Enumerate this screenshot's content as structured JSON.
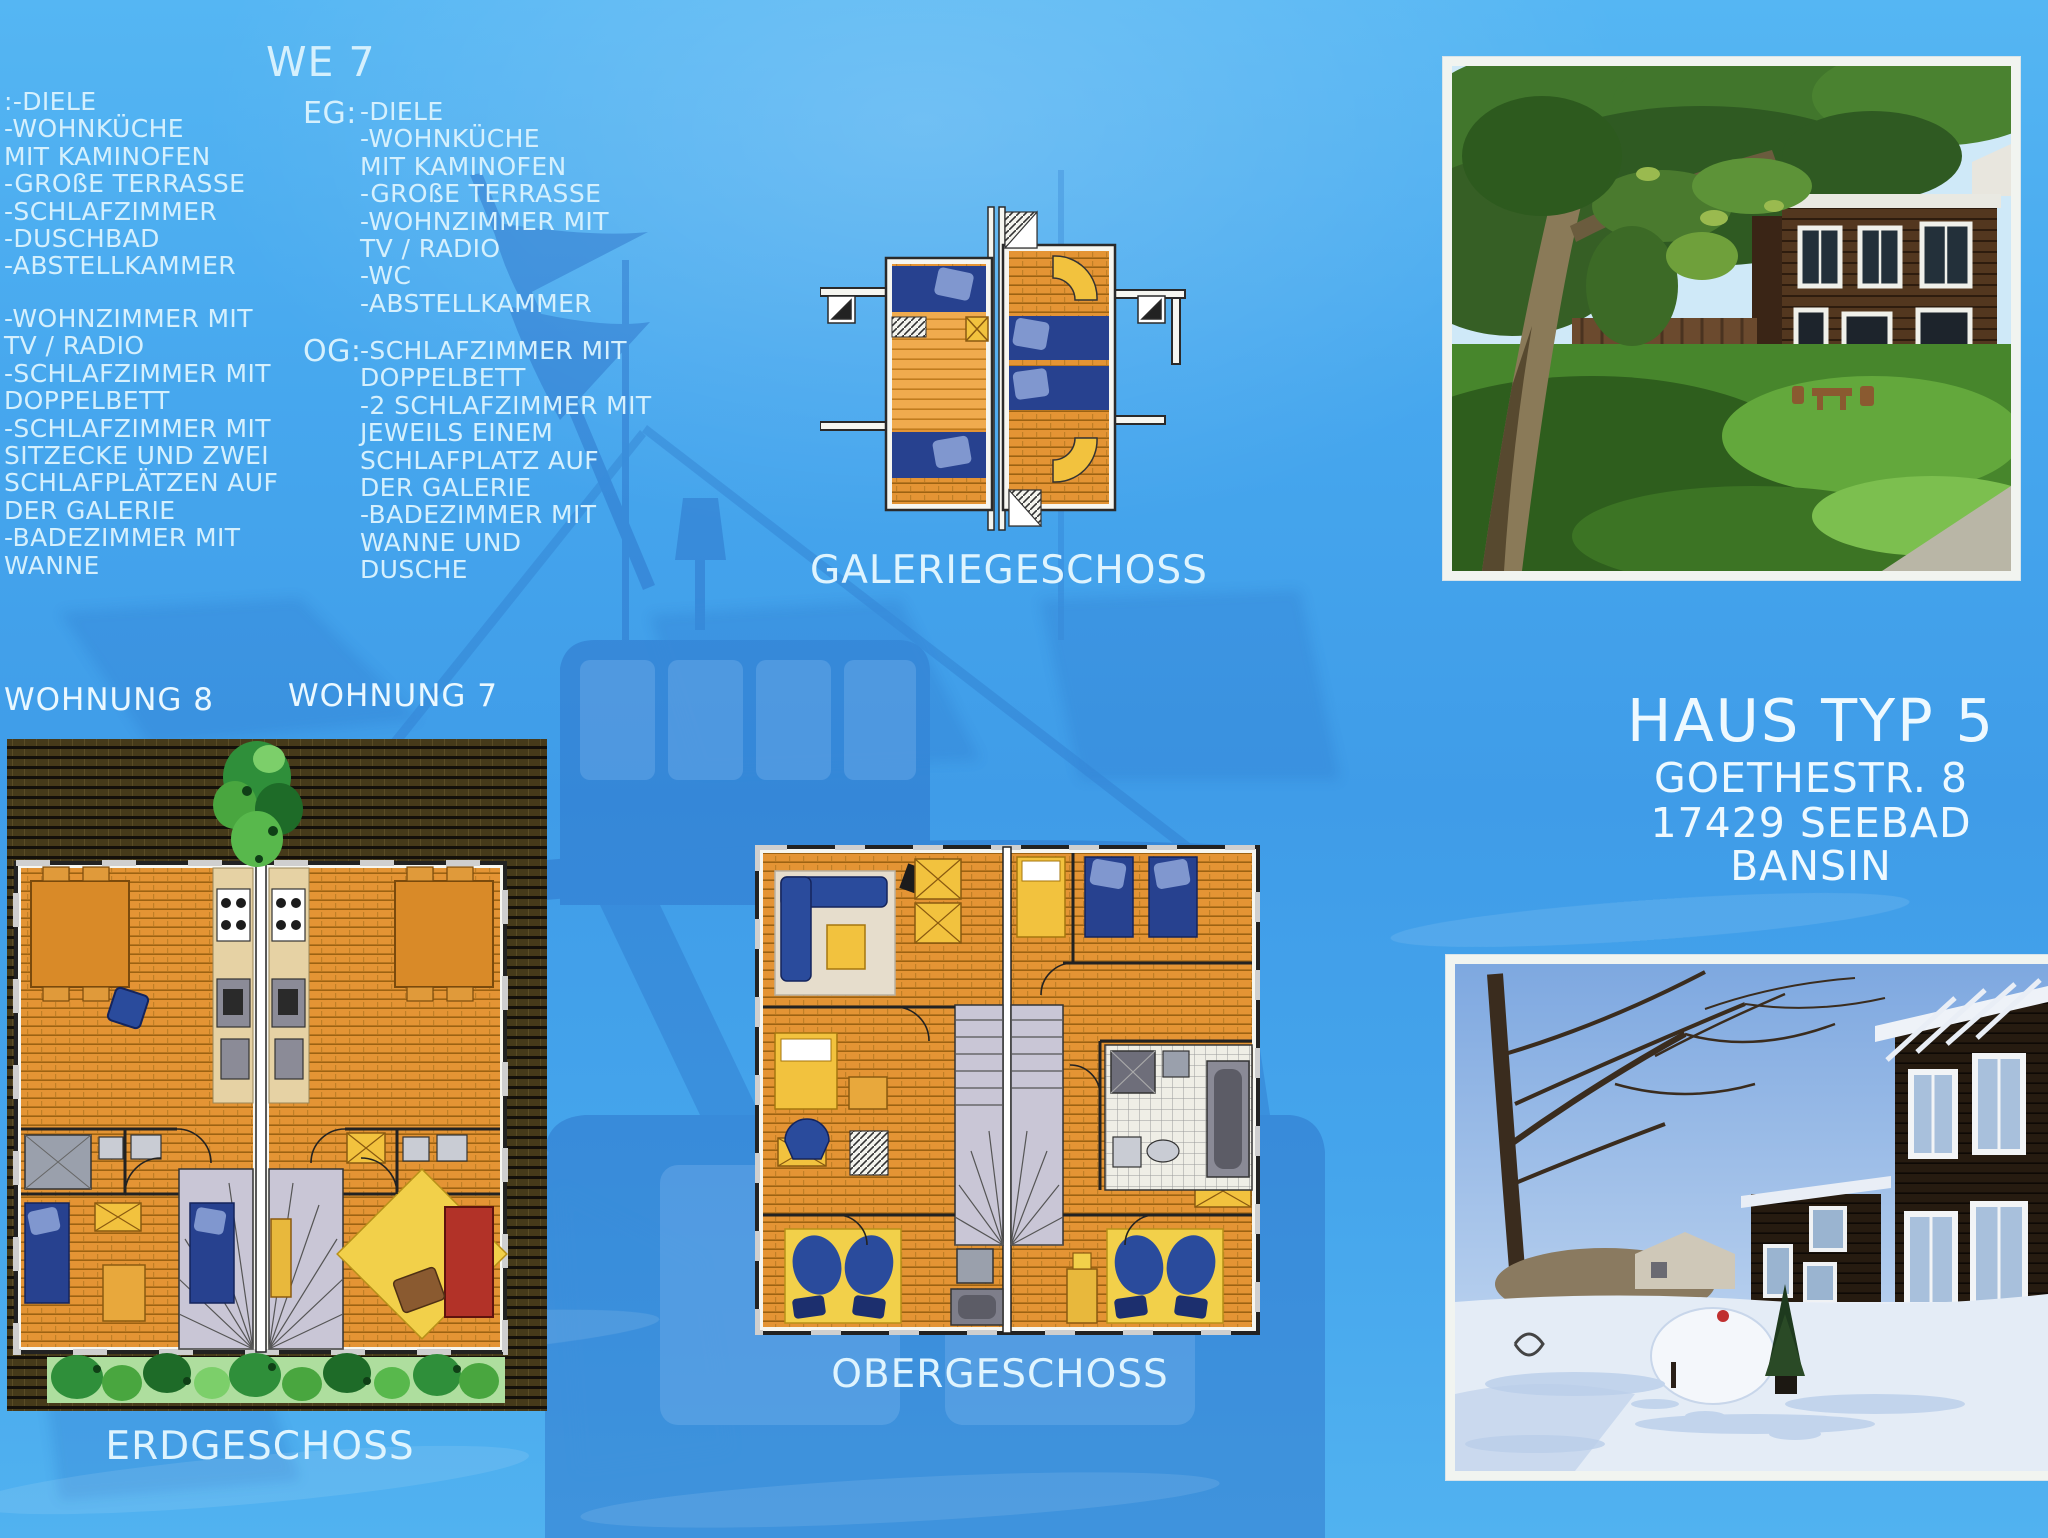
{
  "colors": {
    "bg-top": "#55b6f3",
    "bg-mid": "#3f9ce8",
    "bg-bot": "#51b2f0",
    "text-light": "#d5f0fd",
    "watermark-blue": "#2b6fc5",
    "wood-orange": "#e49434",
    "bed-blue": "#27418f",
    "terrace-brown": "#463a1a",
    "hedge-green": "#2f8f3a"
  },
  "left_column": {
    "block1": [
      ":-DIELE",
      "-WOHNKÜCHE",
      "MIT KAMINOFEN",
      "-GROßE TERRASSE",
      "-SCHLAFZIMMER",
      "-DUSCHBAD",
      "-ABSTELLKAMMER"
    ],
    "block2": [
      "-WOHNZIMMER MIT",
      "TV / RADIO",
      "-SCHLAFZIMMER MIT",
      "DOPPELBETT",
      "-SCHLAFZIMMER MIT",
      "SITZECKE UND ZWEI",
      "SCHLAFPLÄTZEN AUF",
      "DER GALERIE",
      "-BADEZIMMER MIT",
      "WANNE"
    ]
  },
  "we7": {
    "heading": "WE 7",
    "eg_label": "EG:",
    "eg_items": [
      "-DIELE",
      "-WOHNKÜCHE",
      "MIT KAMINOFEN",
      "-GROßE TERRASSE",
      "-WOHNZIMMER MIT",
      "TV / RADIO",
      "-WC",
      "-ABSTELLKAMMER"
    ],
    "og_label": "OG:",
    "og_items": [
      "-SCHLAFZIMMER MIT",
      "DOPPELBETT",
      "-2 SCHLAFZIMMER MIT",
      "JEWEILS EINEM",
      "SCHLAFPLATZ AUF",
      "DER GALERIE",
      "-BADEZIMMER MIT",
      "WANNE UND",
      "DUSCHE"
    ]
  },
  "units": {
    "left": "WOHNUNG 8",
    "right": "WOHNUNG 7"
  },
  "captions": {
    "galerie": "GALERIEGESCHOSS",
    "erdgeschoss": "ERDGESCHOSS",
    "obergeschoss": "OBERGESCHOSS"
  },
  "address": {
    "line1": "HAUS TYP 5",
    "line2": "GOETHESTR. 8",
    "line3": "17429 SEEBAD BANSIN"
  }
}
